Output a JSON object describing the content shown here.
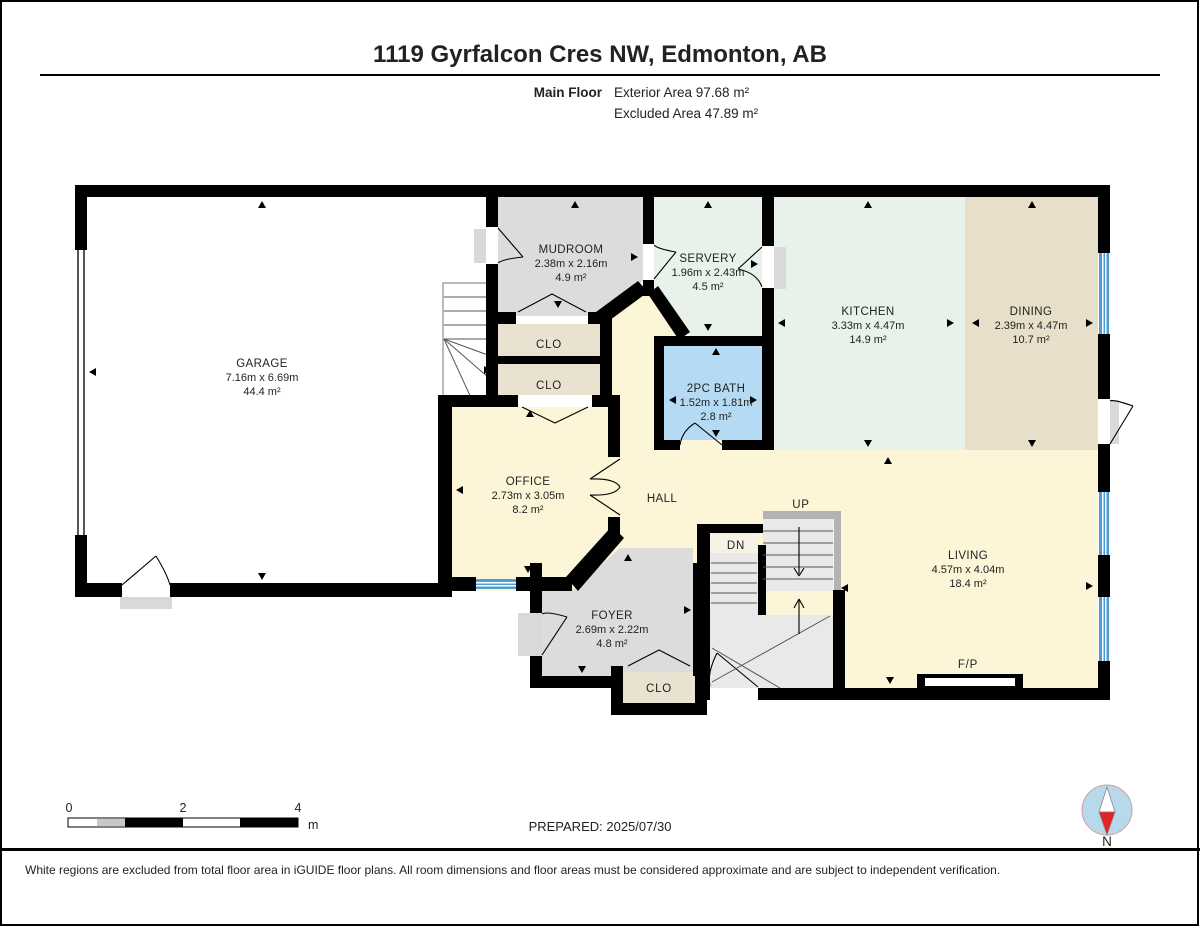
{
  "header": {
    "title": "1119 Gyrfalcon Cres NW, Edmonton, AB",
    "floor_label": "Main Floor",
    "exterior_area": "Exterior Area 97.68 m²",
    "excluded_area": "Excluded Area 47.89 m²"
  },
  "rooms": [
    {
      "id": "garage",
      "name": "GARAGE",
      "dims": "7.16m x 6.69m",
      "area": "44.4 m²"
    },
    {
      "id": "mudroom",
      "name": "MUDROOM",
      "dims": "2.38m x 2.16m",
      "area": "4.9 m²"
    },
    {
      "id": "servery",
      "name": "SERVERY",
      "dims": "1.96m x 2.43m",
      "area": "4.5 m²"
    },
    {
      "id": "kitchen",
      "name": "KITCHEN",
      "dims": "3.33m x 4.47m",
      "area": "14.9 m²"
    },
    {
      "id": "dining",
      "name": "DINING",
      "dims": "2.39m x 4.47m",
      "area": "10.7 m²"
    },
    {
      "id": "bath",
      "name": "2PC BATH",
      "dims": "1.52m x 1.81m",
      "area": "2.8 m²"
    },
    {
      "id": "office",
      "name": "OFFICE",
      "dims": "2.73m x 3.05m",
      "area": "8.2 m²"
    },
    {
      "id": "hall",
      "name": "HALL"
    },
    {
      "id": "living",
      "name": "LIVING",
      "dims": "4.57m x 4.04m",
      "area": "18.4 m²"
    },
    {
      "id": "foyer",
      "name": "FOYER",
      "dims": "2.69m x 2.22m",
      "area": "4.8 m²"
    }
  ],
  "labels": {
    "closet": "CLO",
    "stairs_up": "UP",
    "stairs_down": "DN",
    "fireplace": "F/P"
  },
  "scale_bar": {
    "ticks": [
      "0",
      "2",
      "4"
    ],
    "unit": "m"
  },
  "footer": {
    "prepared": "PREPARED: 2025/07/30",
    "disclaimer": "White regions are excluded from total floor area in iGUIDE floor plans. All room dimensions and floor areas must be considered approximate and are subject to independent verification."
  },
  "compass": {
    "label": "N"
  },
  "colors": {
    "wall": "#000000",
    "excluded_white": "#ffffff",
    "hall_cream": "#fcf5d8",
    "kitchen_mint": "#e8f1ea",
    "dining_tan": "#e7dfc9",
    "room_gray": "#dcdcdc",
    "closet_beige": "#eae2d1",
    "bath_blue": "#b5daf3",
    "window_blue": "#4f9cd3",
    "compass_red": "#e02424"
  }
}
